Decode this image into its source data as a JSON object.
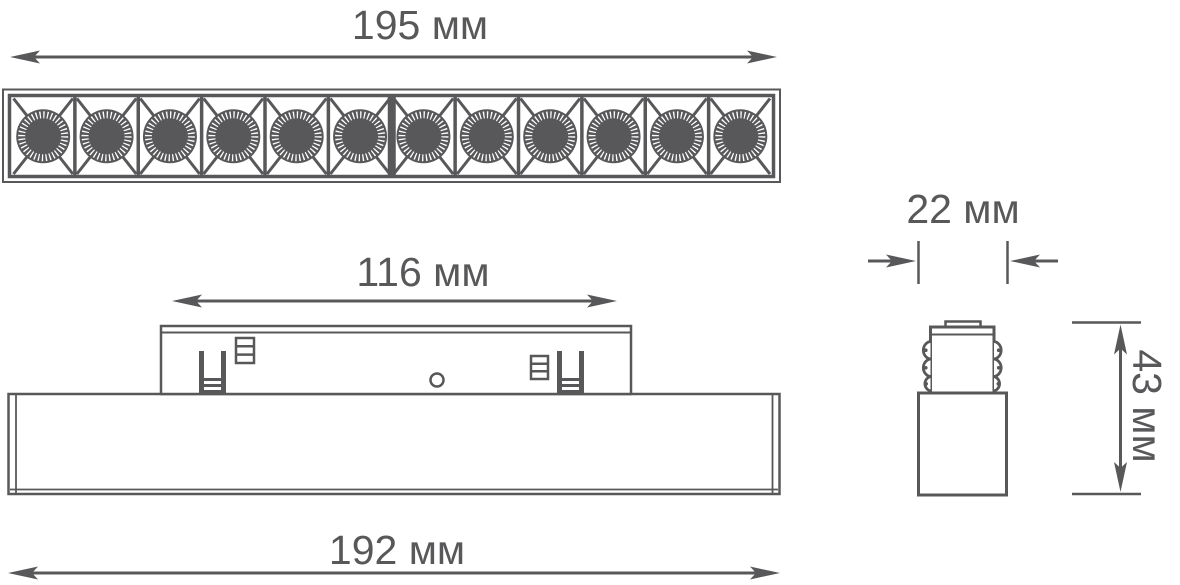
{
  "drawing": {
    "type": "technical-dimension-drawing",
    "subject": "linear-track-luminaire",
    "units": "мм",
    "colors": {
      "line": "#58585a",
      "background": "#ffffff"
    },
    "dimensions": {
      "top_length": "195 мм",
      "adapter_length": "116 мм",
      "body_length": "192 мм",
      "body_width": "22 мм",
      "height": "43 мм"
    },
    "top_view": {
      "led_count": 12
    },
    "views": [
      "top-view",
      "front-view",
      "side-view"
    ]
  }
}
